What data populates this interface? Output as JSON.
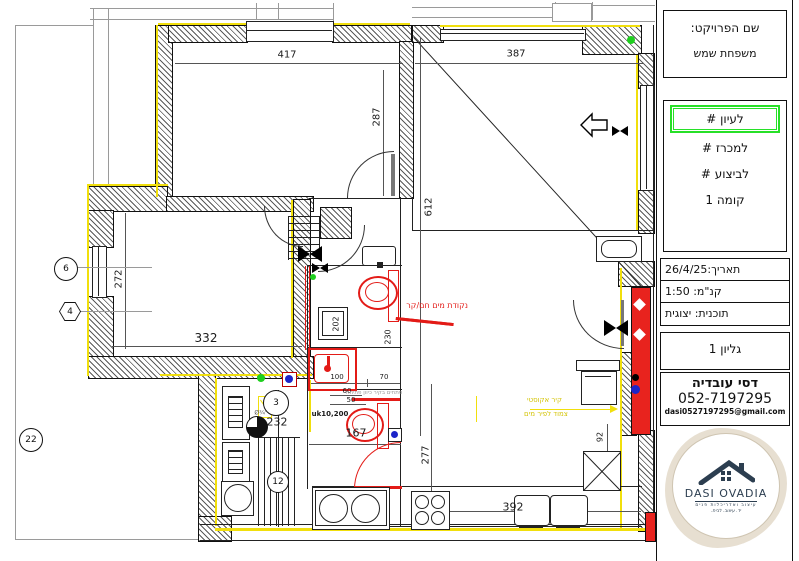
{
  "title_block": {
    "project_label": "שם הפרויקט:",
    "project_name": "משפחת שמש",
    "status_options": [
      {
        "label": "# לעיון"
      },
      {
        "label": "# למכרז"
      },
      {
        "label": "# לביצוע"
      }
    ],
    "floor": "קומה 1",
    "date": "תאריך:26/4/25",
    "scale": "קנ\"מ: 1:50",
    "plan_type": "תוכנית: יצוגית",
    "sheet": "גליון 1",
    "designer_name": "דסי עובדיה",
    "designer_phone": "052-7197295",
    "designer_email": "dasi0527197295@gmail.com",
    "logo_title": "DASI OVADIA",
    "logo_subtitle": "עיצוב ואדריכלות פנים",
    "logo_tagline": "יד. עיצוב. לבית."
  },
  "colors": {
    "highlight_green": "#27e028",
    "wall_yellow": "#f1df0c",
    "plumbing_red": "#e31b17",
    "logo_navy": "#2c3e50",
    "logo_beige": "#e7dfd1",
    "marker_blue": "#1c24c8"
  },
  "plan": {
    "dimensions": [
      {
        "text": "417"
      },
      {
        "text": "387"
      },
      {
        "text": "287"
      },
      {
        "text": "612"
      },
      {
        "text": "272"
      },
      {
        "text": "332"
      },
      {
        "text": "202"
      },
      {
        "text": "230"
      },
      {
        "text": "100"
      },
      {
        "text": "70"
      },
      {
        "text": "60"
      },
      {
        "text": "50"
      },
      {
        "text": "uk10,200"
      },
      {
        "text": "167"
      },
      {
        "text": "277"
      },
      {
        "text": "392"
      },
      {
        "text": "92"
      },
      {
        "text": "232"
      },
      {
        "text": "Ø¾\""
      }
    ],
    "markers": [
      {
        "label": "6"
      },
      {
        "label": "4"
      },
      {
        "label": "22"
      },
      {
        "label": "3"
      },
      {
        "label": "12"
      }
    ],
    "annotations": {
      "water_point": "נקודת מים חם/קר",
      "openings": "פתחים בקיר כיוון פתיחה",
      "acoustic_line1": "קיר אקוסטי",
      "acoustic_line2": "צמוד לפיר מים"
    }
  }
}
